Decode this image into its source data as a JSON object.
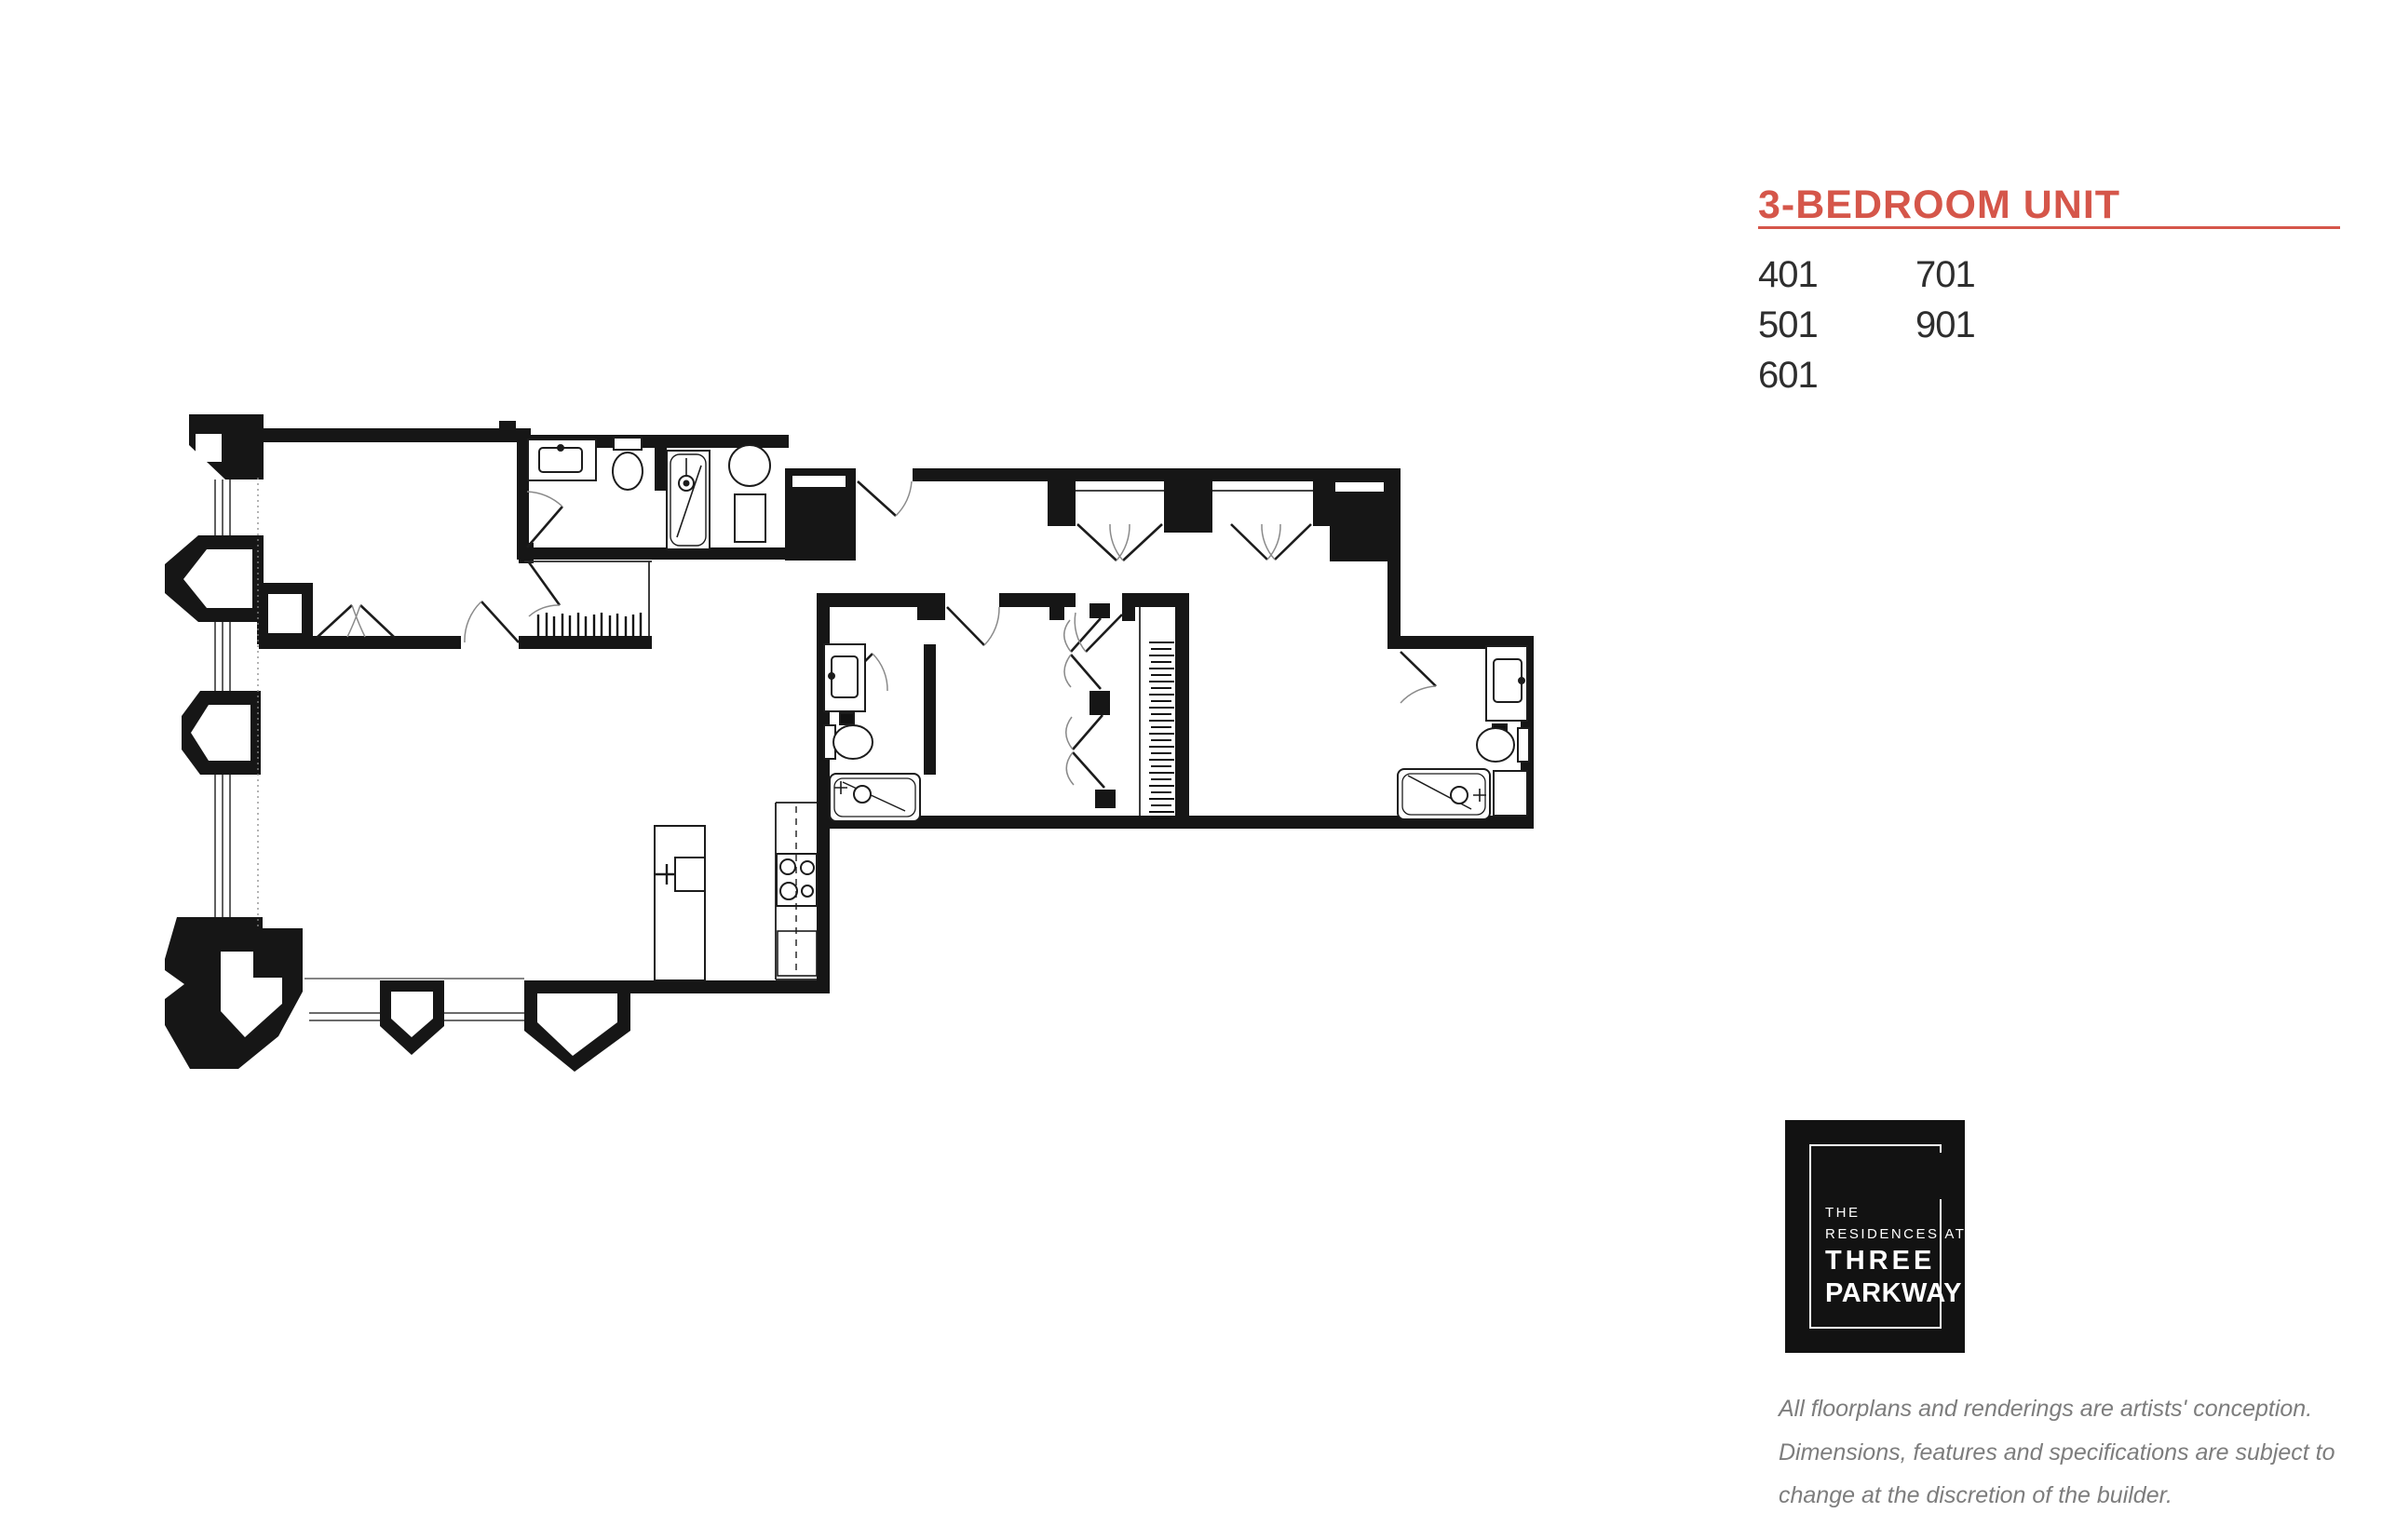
{
  "header": {
    "title": "3-BEDROOM UNIT",
    "accent_color": "#D5564A"
  },
  "units": {
    "col1": [
      "401",
      "501",
      "601"
    ],
    "col2": [
      "701",
      "901"
    ]
  },
  "logo": {
    "line1": "THE",
    "line2": "RESIDENCES AT",
    "line3": "THREE",
    "line4": "PARKWAY",
    "background": "#121212",
    "text_color": "#ffffff"
  },
  "disclaimer": {
    "line1": "All floorplans and renderings are artists' conception.",
    "line2": "Dimensions, features and specifications are subject to",
    "line3": "change at the discretion of the builder."
  },
  "floor_plan": {
    "type": "architectural-line-drawing",
    "ink_color": "#161616",
    "features": [
      "bay-windows",
      "bedroom-1",
      "bath-1-with-shower",
      "walk-in-closets",
      "foyer-entry",
      "hall-closets",
      "bedroom-2",
      "bath-2-with-tub",
      "bedroom-3",
      "bath-3-with-tub",
      "kitchen-island-with-sink",
      "kitchen-counter-with-range",
      "living-dining-area",
      "service-shafts"
    ]
  }
}
